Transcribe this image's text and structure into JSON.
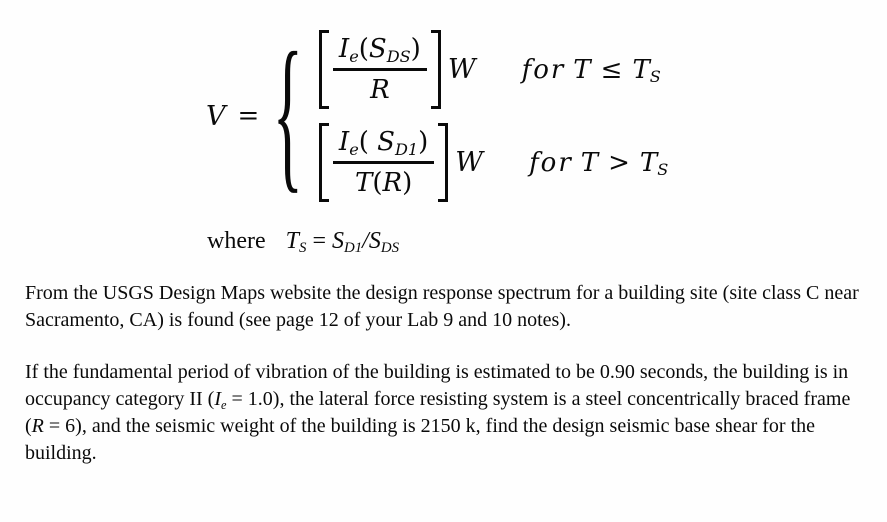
{
  "equation": {
    "lhs": "V",
    "equals": "=",
    "brace": "{",
    "cases": [
      {
        "numerator": {
          "i": "I",
          "i_sub": "e",
          "open": "(",
          "s": "S",
          "s_sub": "DS",
          "close": ")"
        },
        "denominator": {
          "r": "R"
        },
        "weight": "W",
        "condition": {
          "word": "for",
          "var": "T",
          "op": "≤",
          "limit": "T",
          "limit_sub": "S"
        }
      },
      {
        "numerator": {
          "i": "I",
          "i_sub": "e",
          "open": "( ",
          "s": "S",
          "s_sub": "D1",
          "close": ")"
        },
        "denominator": {
          "t": "T",
          "open": "(",
          "r": "R",
          "close": ")"
        },
        "weight": "W",
        "condition": {
          "word": "for",
          "var": "T",
          "op": ">",
          "limit": "T",
          "limit_sub": "S"
        }
      }
    ]
  },
  "where": {
    "word": "where",
    "t": "T",
    "t_sub": "S",
    "equals": " = ",
    "s1": "S",
    "s1_sub": "D1",
    "slash": "/",
    "s2": "S",
    "s2_sub": "DS"
  },
  "paragraphs": {
    "p1": "From the USGS Design Maps website the design response spectrum for a building site (site class C near Sacramento, CA) is found (see page 12 of your Lab 9 and 10 notes).",
    "p2": {
      "part1": "If the fundamental period of vibration of the building is estimated to be 0.90 seconds, the building is in occupancy category II (",
      "var1": "I",
      "var1_sub": "e",
      "part2": " = 1.0), the lateral force resisting system is a steel concentrically braced frame (",
      "var2": "R",
      "part3": " = 6), and the seismic weight of the building is 2150 k, find the design seismic base shear for the building."
    }
  }
}
